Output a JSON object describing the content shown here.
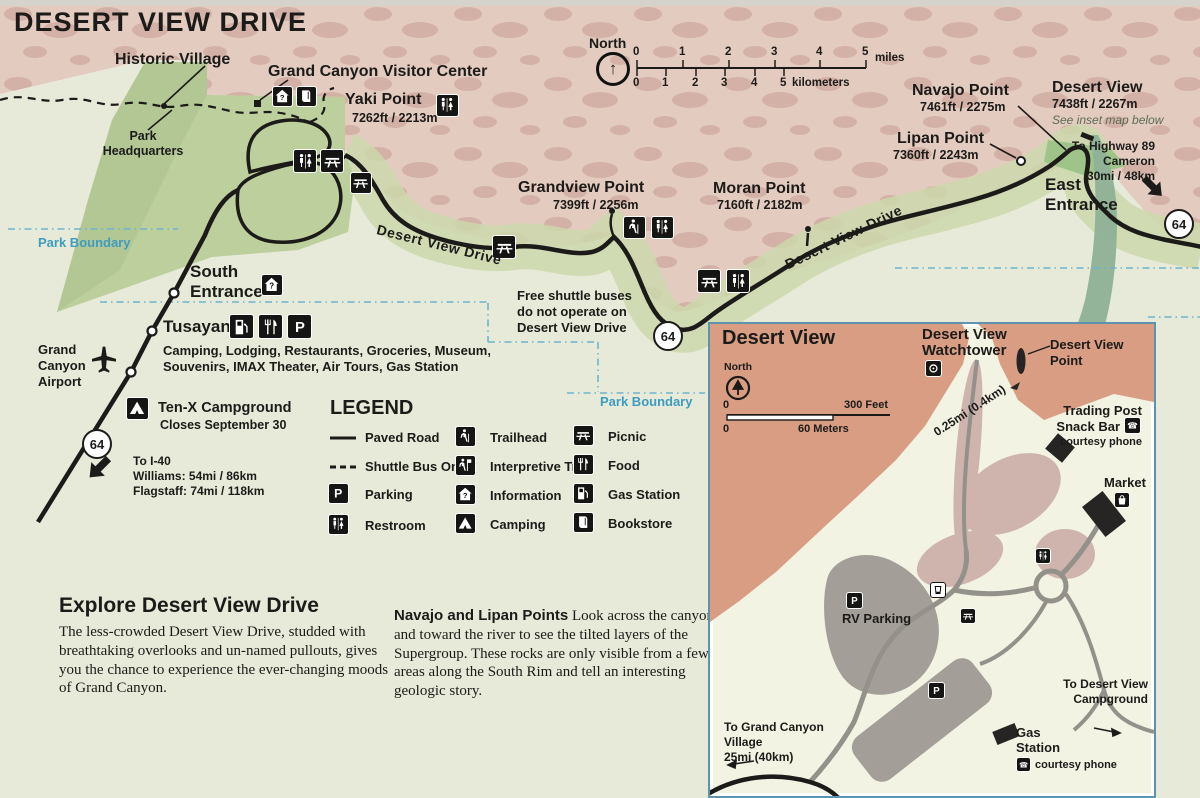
{
  "title": "DESERT VIEW DRIVE",
  "compass": {
    "north": "North"
  },
  "scale_main": {
    "miles_ticks": [
      "0",
      "1",
      "2",
      "3",
      "4",
      "5"
    ],
    "miles_label": "miles",
    "km_ticks": [
      "0",
      "1",
      "2",
      "3",
      "4",
      "5"
    ],
    "km_label": "kilometers"
  },
  "points": {
    "historic_village": "Historic Village",
    "visitor_center": "Grand Canyon Visitor Center",
    "yaki": {
      "name": "Yaki Point",
      "elev": "7262ft / 2213m"
    },
    "park_hq": [
      "Park",
      "Headquarters"
    ],
    "grandview": {
      "name": "Grandview Point",
      "elev": "7399ft / 2256m"
    },
    "moran": {
      "name": "Moran Point",
      "elev": "7160ft / 2182m"
    },
    "navajo": {
      "name": "Navajo Point",
      "elev": "7461ft / 2275m"
    },
    "lipan": {
      "name": "Lipan Point",
      "elev": "7360ft / 2243m"
    },
    "desert_view": {
      "name": "Desert View",
      "elev": "7438ft / 2267m",
      "note": "See inset map below"
    },
    "east_entrance": [
      "East",
      "Entrance"
    ],
    "south_entrance": [
      "South",
      "Entrance"
    ],
    "tusayan": {
      "name": "Tusayan",
      "desc1": "Camping, Lodging, Restaurants, Groceries, Museum,",
      "desc2": "Souvenirs, IMAX Theater, Air Tours, Gas Station"
    },
    "airport": [
      "Grand",
      "Canyon",
      "Airport"
    ],
    "tenx": {
      "name": "Ten-X Campground",
      "note": "Closes September 30"
    },
    "to_i40": [
      "To I-40",
      "Williams: 54mi / 86km",
      "Flagstaff: 74mi / 118km"
    ],
    "to_hwy89": [
      "To Highway 89",
      "Cameron",
      "30mi / 48km"
    ],
    "shuttle_note": [
      "Free shuttle buses",
      "do not operate on",
      "Desert View Drive"
    ],
    "road_label": "Desert View Drive",
    "park_boundary": "Park Boundary",
    "route": "64"
  },
  "legend": {
    "title": "LEGEND",
    "items": [
      {
        "icon": "paved-road",
        "label": "Paved Road"
      },
      {
        "icon": "shuttle-bus-only",
        "label": "Shuttle Bus Only"
      },
      {
        "icon": "parking",
        "label": "Parking"
      },
      {
        "icon": "restroom",
        "label": "Restroom"
      },
      {
        "icon": "trailhead",
        "label": "Trailhead"
      },
      {
        "icon": "interpretive-trail",
        "label": "Interpretive Trail"
      },
      {
        "icon": "information",
        "label": "Information"
      },
      {
        "icon": "camping",
        "label": "Camping"
      },
      {
        "icon": "picnic",
        "label": "Picnic"
      },
      {
        "icon": "food",
        "label": "Food"
      },
      {
        "icon": "gas-station",
        "label": "Gas Station"
      },
      {
        "icon": "bookstore",
        "label": "Bookstore"
      }
    ]
  },
  "explore": {
    "heading": "Explore Desert View Drive",
    "body": "The less-crowded Desert View Drive, studded with breathtaking overlooks and un-named pullouts, gives you the chance to experience the ever-changing moods of Grand Canyon."
  },
  "navajo_lipan": {
    "lead": "Navajo and Lipan Points",
    "body": " Look across the canyon and toward the river to see the tilted layers of the Supergroup. These rocks are only visible from a few areas along the South Rim and tell an interesting geologic story."
  },
  "inset": {
    "title": "Desert View",
    "north": "North",
    "scale": {
      "zero_ft": "0",
      "feet": "300 Feet",
      "zero_m": "0",
      "meters": "60 Meters"
    },
    "watchtower": [
      "Desert View",
      "Watchtower"
    ],
    "point": [
      "Desert View",
      "Point"
    ],
    "trading_post": [
      "Trading Post",
      "Snack Bar"
    ],
    "courtesy_phone": "courtesy phone",
    "market": "Market",
    "rv_parking": "RV Parking",
    "gas_station": [
      "Gas",
      "Station"
    ],
    "to_campground": [
      "To Desert View",
      "Campground"
    ],
    "to_village": [
      "To Grand Canyon",
      "Village",
      "25mi (40km)"
    ],
    "distance": "0.25mi (0.4km)"
  },
  "colors": {
    "terrain_pink": "#e3cbbf",
    "forest_green": "#bccf9d",
    "inset_salmon": "#d89d82",
    "boundary_blue": "#3e9cc0",
    "road_black": "#1c1b19",
    "inset_border_blue": "#5f93ad"
  }
}
